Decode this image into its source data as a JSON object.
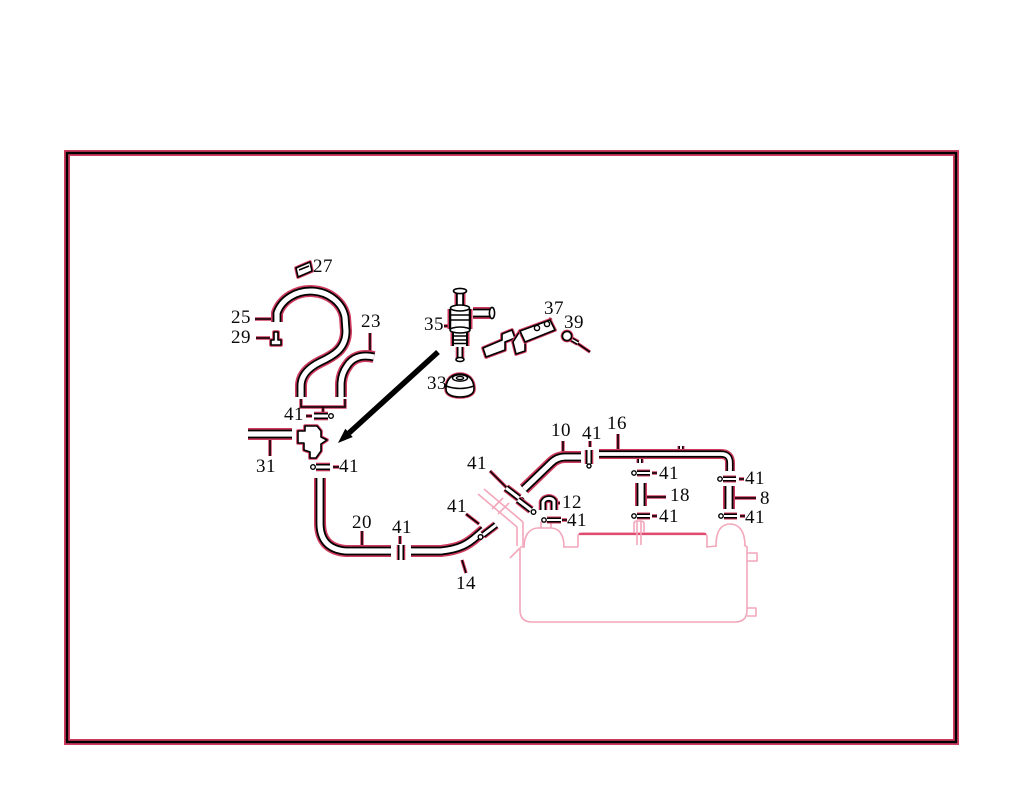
{
  "figure": {
    "kind": "exploded-parts-diagram",
    "part_numbers": [
      "8",
      "10",
      "12",
      "14",
      "16",
      "18",
      "20",
      "23",
      "25",
      "27",
      "29",
      "31",
      "33",
      "35",
      "37",
      "39",
      "41"
    ],
    "labels": {
      "l27": "27",
      "l25": "25",
      "l29": "29",
      "l23": "23",
      "l35": "35",
      "l37": "37",
      "l39": "39",
      "l33": "33",
      "l41a": "41",
      "l31": "31",
      "l41b": "41",
      "l20": "20",
      "l41c": "41",
      "l41d": "41",
      "l14": "14",
      "l41e": "41",
      "l10": "10",
      "l41f": "41",
      "l16": "16",
      "l12": "12",
      "l41g": "41",
      "l41h": "41",
      "l18": "18",
      "l41i": "41",
      "l41j": "41",
      "l8": "8",
      "l41k": "41"
    },
    "colors": {
      "line": "#000000",
      "accent": "#cf3b5e",
      "tank_outline": "#f2a7bb",
      "tank_accent": "#e04b70",
      "background": "#ffffff"
    }
  }
}
